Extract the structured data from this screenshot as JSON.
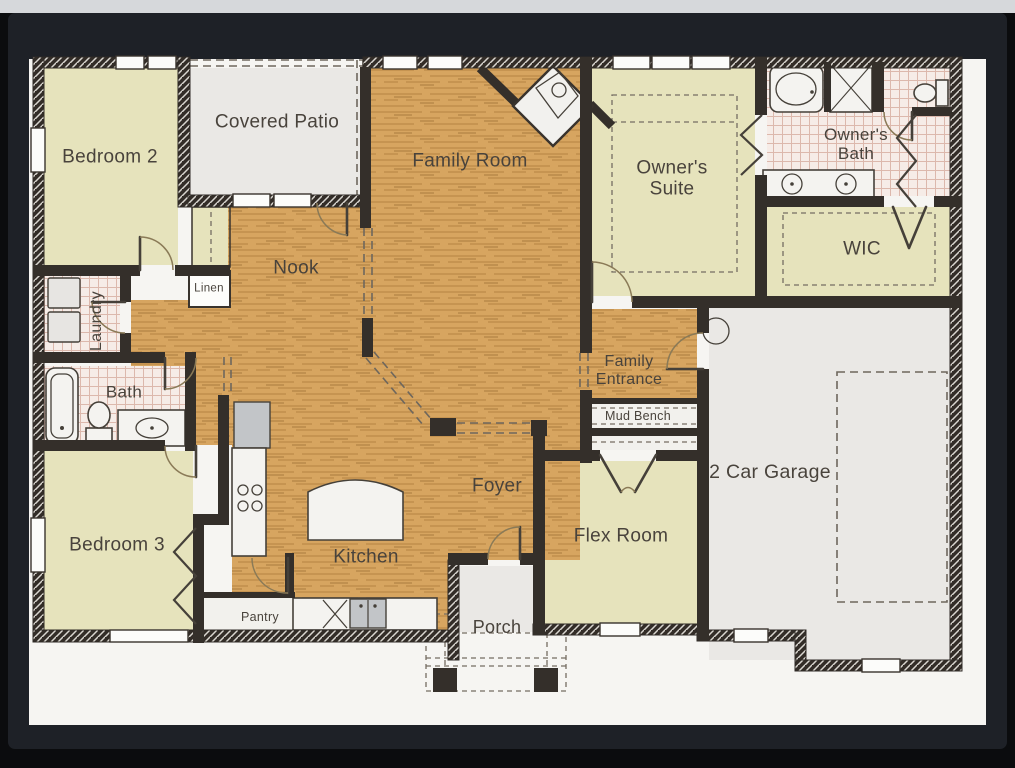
{
  "photo": {
    "description": "Photograph of a single-story residential floor plan displayed on a screen",
    "colors": {
      "backdrop": "#0b0c0e",
      "top-strip": "#d6d8db",
      "bezel": "#1e2127",
      "page": "#f6f5f2",
      "wall": "#342f2a",
      "wood": "#d7a560",
      "room-green": "#e6e3bc",
      "floor-gray": "#eae8e5",
      "tile": "#f6ece7",
      "label": "#49433c"
    }
  },
  "rooms": {
    "bedroom2": "Bedroom 2",
    "covered_patio": "Covered Patio",
    "family_room": "Family Room",
    "owners_suite": "Owner's Suite",
    "owners_bath": "Owner's Bath",
    "wic": "WIC",
    "nook": "Nook",
    "linen": "Linen",
    "laundry": "Laundry",
    "bath": "Bath",
    "bedroom3": "Bedroom 3",
    "kitchen": "Kitchen",
    "pantry": "Pantry",
    "foyer": "Foyer",
    "family_entrance": "Family Entrance",
    "mud_bench": "Mud Bench",
    "garage": "2 Car Garage",
    "flex_room": "Flex Room",
    "porch": "Porch"
  }
}
